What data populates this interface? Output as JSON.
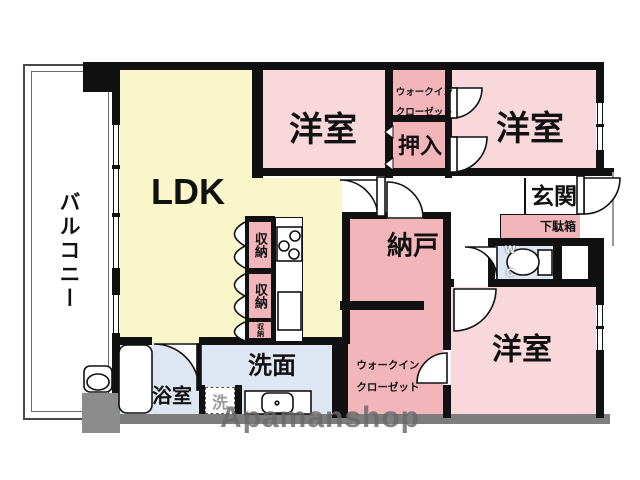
{
  "floorplan": {
    "labels": {
      "balcony": "バルコニー",
      "ldk": "LDK",
      "room1": "洋室",
      "room2": "洋室",
      "room3": "洋室",
      "wic1_line1": "ウォークイン",
      "wic1_line2": "クローゼット",
      "wic2_line1": "ウォークイン",
      "wic2_line2": "クローゼット",
      "oshiire": "押入",
      "nando": "納戸",
      "genkan": "玄関",
      "getabako": "下駄箱",
      "wc_line1": "W",
      "wc_line2": "C",
      "senmen": "洗面",
      "yokushitsu": "浴室",
      "laundry": "洗",
      "storage1": "収納",
      "storage2": "収納",
      "storage3": "収納"
    },
    "watermark": "Apamanshop",
    "colors": {
      "ldk": "#f9f6c9",
      "room": "#f8d8da",
      "closet": "#f2b5ba",
      "wet": "#dde6f2",
      "wall": "#111111",
      "bottom_wall": "#7d7d7d",
      "gray_block": "#8c8c8c"
    }
  }
}
